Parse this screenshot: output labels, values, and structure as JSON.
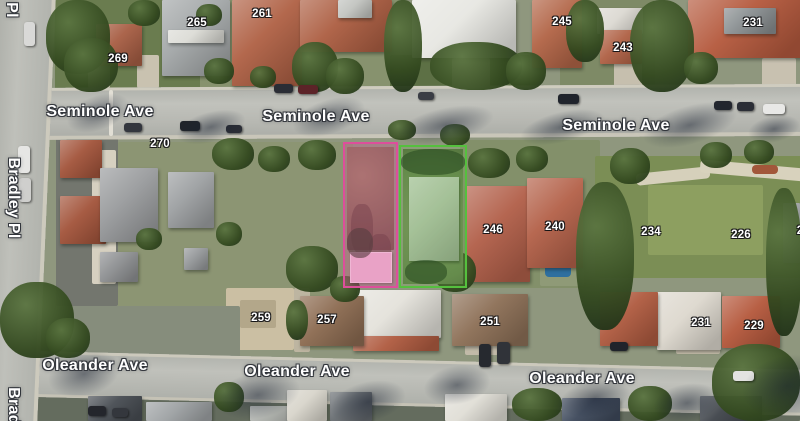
{
  "map": {
    "view_type": "satellite",
    "highlight_colors": {
      "pink_outline": "#dd4f9b",
      "pink_fill": "rgba(221,79,155,0.30)",
      "green_outline": "#55c03e",
      "green_fill": "rgba(110,200,80,0.16)"
    }
  },
  "street_labels": [
    {
      "text": "Seminole Ave",
      "x": 100,
      "y": 112,
      "rotation": 0
    },
    {
      "text": "Seminole Ave",
      "x": 316,
      "y": 117,
      "rotation": 0
    },
    {
      "text": "Seminole Ave",
      "x": 616,
      "y": 126,
      "rotation": 0
    },
    {
      "text": "Oleander Ave",
      "x": 95,
      "y": 366,
      "rotation": 0
    },
    {
      "text": "Oleander Ave",
      "x": 297,
      "y": 372,
      "rotation": 0
    },
    {
      "text": "Oleander Ave",
      "x": 582,
      "y": 379,
      "rotation": 0
    },
    {
      "text": "Bradley Pl",
      "x": 13,
      "y": 198,
      "rotation": 90
    },
    {
      "text": "Pl",
      "x": 11,
      "y": 10,
      "rotation": 90
    },
    {
      "text": "Brad",
      "x": 13,
      "y": 406,
      "rotation": 90
    }
  ],
  "house_numbers": [
    {
      "text": "265",
      "x": 197,
      "y": 23
    },
    {
      "text": "261",
      "x": 262,
      "y": 14
    },
    {
      "text": "269",
      "x": 118,
      "y": 59
    },
    {
      "text": "245",
      "x": 562,
      "y": 22
    },
    {
      "text": "243",
      "x": 623,
      "y": 48
    },
    {
      "text": "231",
      "x": 753,
      "y": 23
    },
    {
      "text": "270",
      "x": 160,
      "y": 144
    },
    {
      "text": "246",
      "x": 493,
      "y": 230
    },
    {
      "text": "240",
      "x": 555,
      "y": 227
    },
    {
      "text": "234",
      "x": 651,
      "y": 232
    },
    {
      "text": "226",
      "x": 741,
      "y": 235
    },
    {
      "text": "259",
      "x": 261,
      "y": 318
    },
    {
      "text": "257",
      "x": 327,
      "y": 320
    },
    {
      "text": "251",
      "x": 490,
      "y": 322
    },
    {
      "text": "231",
      "x": 701,
      "y": 323
    },
    {
      "text": "229",
      "x": 754,
      "y": 326
    },
    {
      "text": "2",
      "x": 800,
      "y": 231
    }
  ],
  "parcels": [
    {
      "id": "pink",
      "x": 343,
      "y": 142,
      "w": 55,
      "h": 146,
      "outline": "#dd4f9b",
      "fill": "rgba(221,79,155,0.30)"
    },
    {
      "id": "green",
      "x": 399,
      "y": 145,
      "w": 68,
      "h": 143,
      "outline": "#55c03e",
      "fill": "rgba(110,200,80,0.16)"
    }
  ]
}
